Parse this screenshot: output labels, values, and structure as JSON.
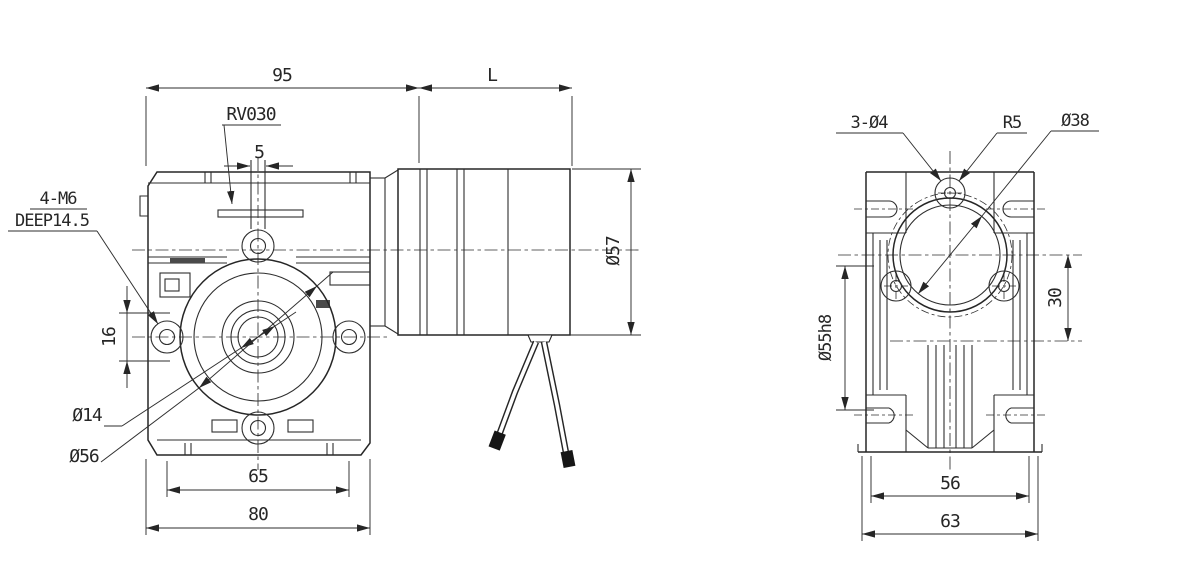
{
  "title": "RV030 worm gearbox dimensional drawing",
  "colors": {
    "line": "#262626",
    "background": "#ffffff"
  },
  "side_view": {
    "model": "RV030",
    "dims": {
      "housing_length": "95",
      "motor_length": "L",
      "slot_width": "5",
      "flange_offset": "16",
      "output_bore": "Ø14",
      "spigot_diameter": "Ø56",
      "bolt_spacing": "65",
      "housing_width": "80",
      "motor_diameter": "Ø57"
    },
    "notes": {
      "tapped_holes": "4-M6",
      "tap_depth": "DEEP14.5"
    }
  },
  "front_view": {
    "dims": {
      "mount_holes": "3-Ø4",
      "boss_radius": "R5",
      "input_bore": "Ø38",
      "output_boss": "Ø55h8",
      "center_distance": "30",
      "foot_spacing": "56",
      "overall_width": "63"
    }
  }
}
